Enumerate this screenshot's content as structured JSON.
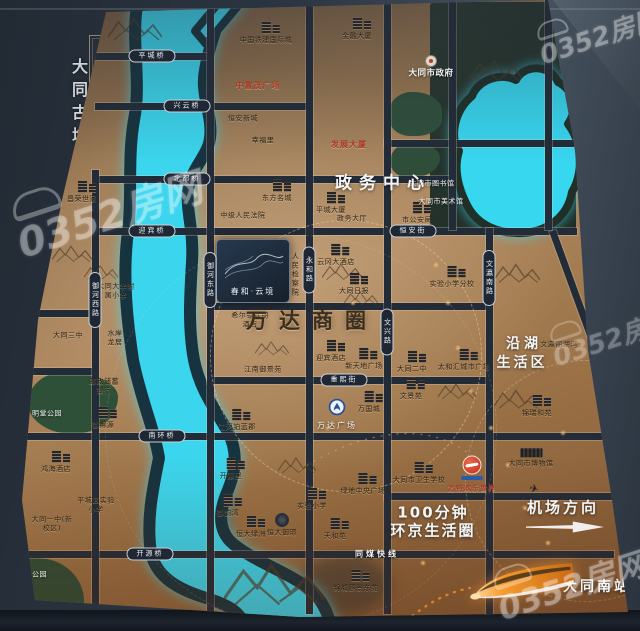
{
  "watermark_text": "0352房网",
  "wall": {
    "ancient_city_label": "大同古城"
  },
  "zones": {
    "government_center": "政务中心",
    "wanda_district": "万达商圈",
    "lakeside_1": "沿湖",
    "lakeside_2": "生活区",
    "airport_direction": "机场方向",
    "minutes_1": "100分钟",
    "minutes_2": "环京生活圈",
    "south_station": "大同南站"
  },
  "roads": {
    "pingcheng_bridge": "平城桥",
    "xingyun_bridge": "兴云桥",
    "beidu_bridge": "北都桥",
    "yingbin_bridge": "迎宾桥",
    "hengan_street": "恒安街",
    "chongxi_street": "重熙街",
    "nanhuan_bridge": "南环桥",
    "kaiyuan_bridge": "开源桥",
    "tongmei_express": "同煤快线",
    "yuhe_west_road": "御河西路",
    "yuhe_east_road": "御河东路",
    "yonghe_road": "永和路",
    "wenxing_road": "文兴路",
    "wenying_south_road": "文瀛南路"
  },
  "project": {
    "name": "春和·云境"
  },
  "landmarks": {
    "changrong": "昌荣世家",
    "jinrong": "金融大厦",
    "zhongtiejian": "中国铁建国际城",
    "zhongzhimao": "中置茂广场",
    "henganxincheng": "恒安新城",
    "xingfuli": "幸福里",
    "fazhandasha": "发展大厦",
    "dongfangmingcheng": "东方名城",
    "zhongjifayuan": "中级人民法院",
    "pingchengdasha": "平城大厦",
    "zhengwudating": "政务大厅",
    "gonganju": "市公安局",
    "tushuguan": "大同市图书馆",
    "meishuguan": "大同市美术馆",
    "shizhengfu": "大同市政府",
    "fuxiao": "大同大学附属小学",
    "sanzhong": "大同三中",
    "shuianlongju": "水岸龙居",
    "youzheng": "邮政储蓄银行",
    "yujinyuan": "御锦源",
    "mingtang": "明堂公园",
    "honghai": "鸿海酒店",
    "pingchengxiaoxue": "平城区实验小学",
    "yizhong": "大同一中(新校区)",
    "binhe": "滨河公园",
    "jianchayuan": "人民检察院",
    "yungang": "云冈大酒店",
    "ribao": "大同日报",
    "xierdun": "希尔顿欢朋酒店",
    "jiangnan": "江南御景苑",
    "yingbinjiudian": "迎宾酒店",
    "xintiandi": "新天地广场",
    "erzhong": "大同二中",
    "jianghe": "江河铂蓝郡",
    "wandaguangchang": "万达广场",
    "wanguocheng": "万国城",
    "wenjingyuan": "文景苑",
    "taihehui": "太和汇城市广场",
    "shiyanfenxiao": "实验小学分校",
    "wenyinglihuwan": "文瀛丽湖湾",
    "jinruiheyuan": "锦瑞和苑",
    "kaiyuanli": "开源里",
    "yuyunwan": "御韵湾",
    "hengdalvzhou": "恒大绿洲",
    "hengdayujing": "恒大御璟",
    "shiyanxiaoxue": "实验小学",
    "lvdizhongyang": "绿地中央广场",
    "tianheyuan": "天和苑",
    "jinchengyuan": "锦城颐景东苑",
    "weishengxuexiao": "大同市卫生学校",
    "fante": "方特欢乐世界",
    "bowuguan": "大同市博物馆"
  },
  "colors": {
    "river": "#3bd6ee",
    "bronze": "#a07550",
    "road": "#222c39",
    "accent_orange": "#f59a2c"
  }
}
